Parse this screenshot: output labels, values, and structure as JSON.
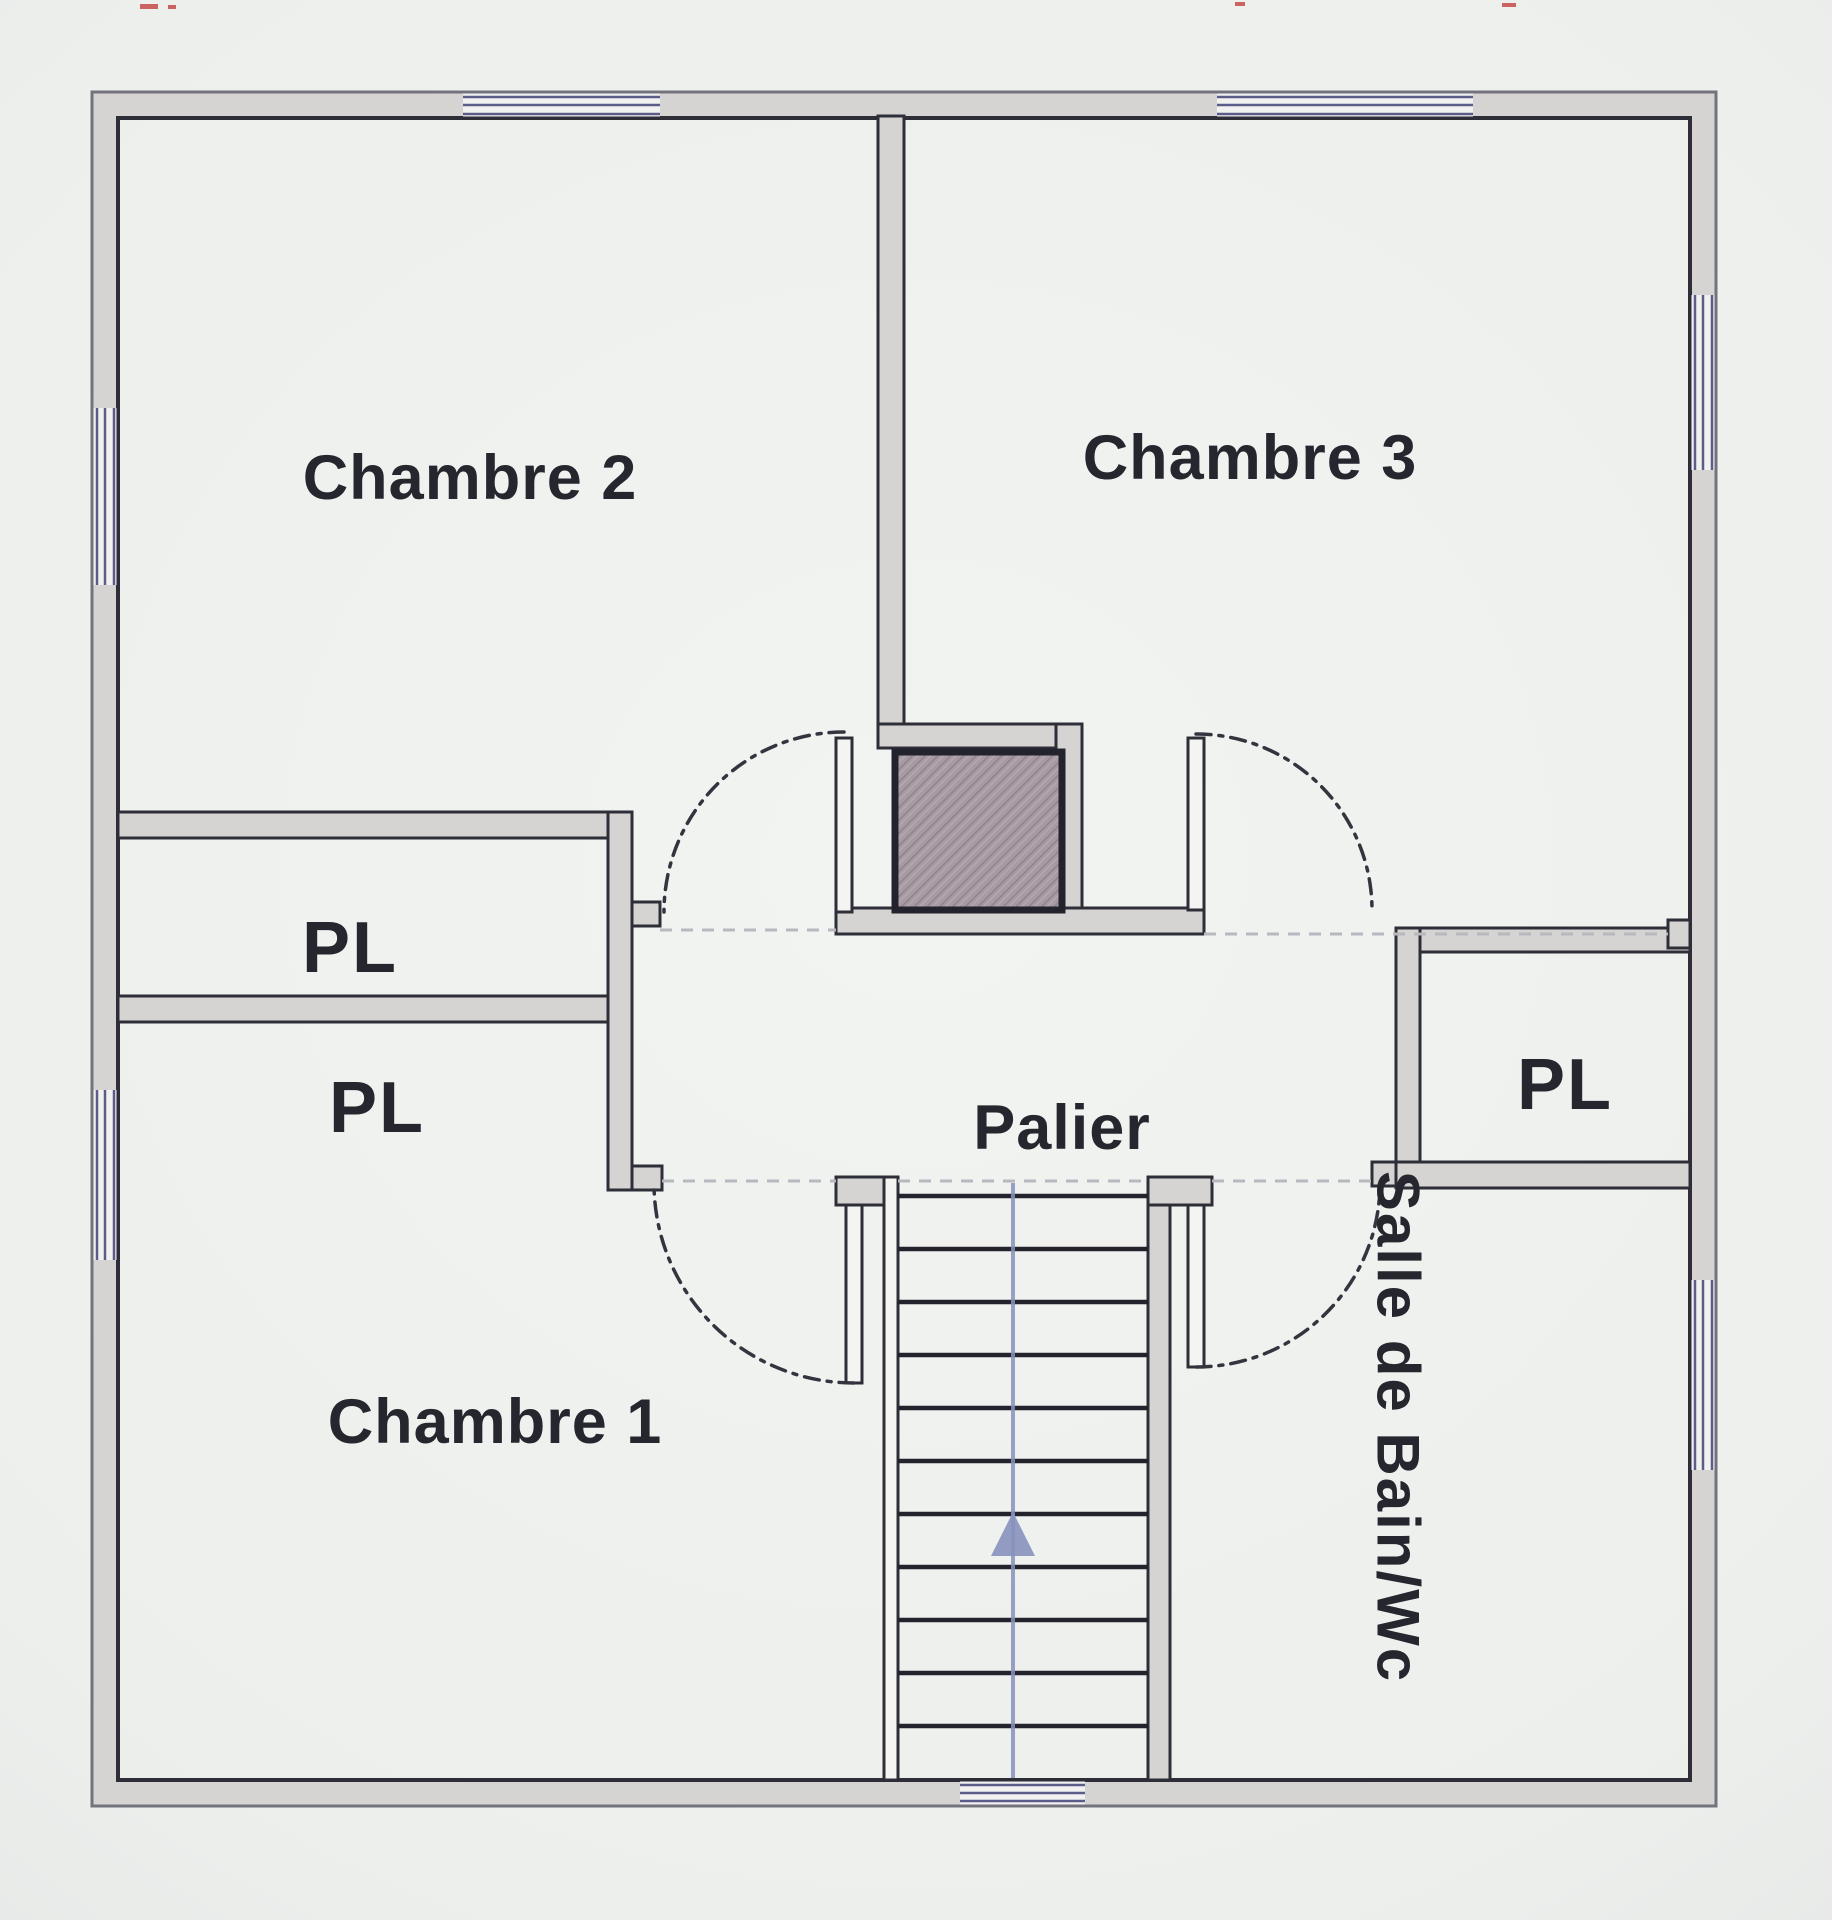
{
  "labels": {
    "chambre1": "Chambre 1",
    "chambre2": "Chambre 2",
    "chambre3": "Chambre 3",
    "palier": "Palier",
    "pl_left_upper": "PL",
    "pl_left_lower": "PL",
    "pl_right": "PL",
    "salle_de_bain": "Salle de Bain/Wc"
  },
  "stairs": {
    "treads": 11,
    "direction_arrow": "up"
  },
  "colors": {
    "paper": "#eef0ee",
    "wall-line": "#2e2e38",
    "wall-edge-soft": "#73737d",
    "wall-fill": "#d5d4d2",
    "window-line": "#5c5c8a",
    "window-fill": "#f1f2f0",
    "chimney-fill": "#a79aa3",
    "chimney-line": "#23232e",
    "arc": "#34343e",
    "guide": "#b8b8bf",
    "tread": "#23232d",
    "arrow-blue": "#8792bc",
    "label": "#26262e",
    "speck-red": "#c24040"
  }
}
